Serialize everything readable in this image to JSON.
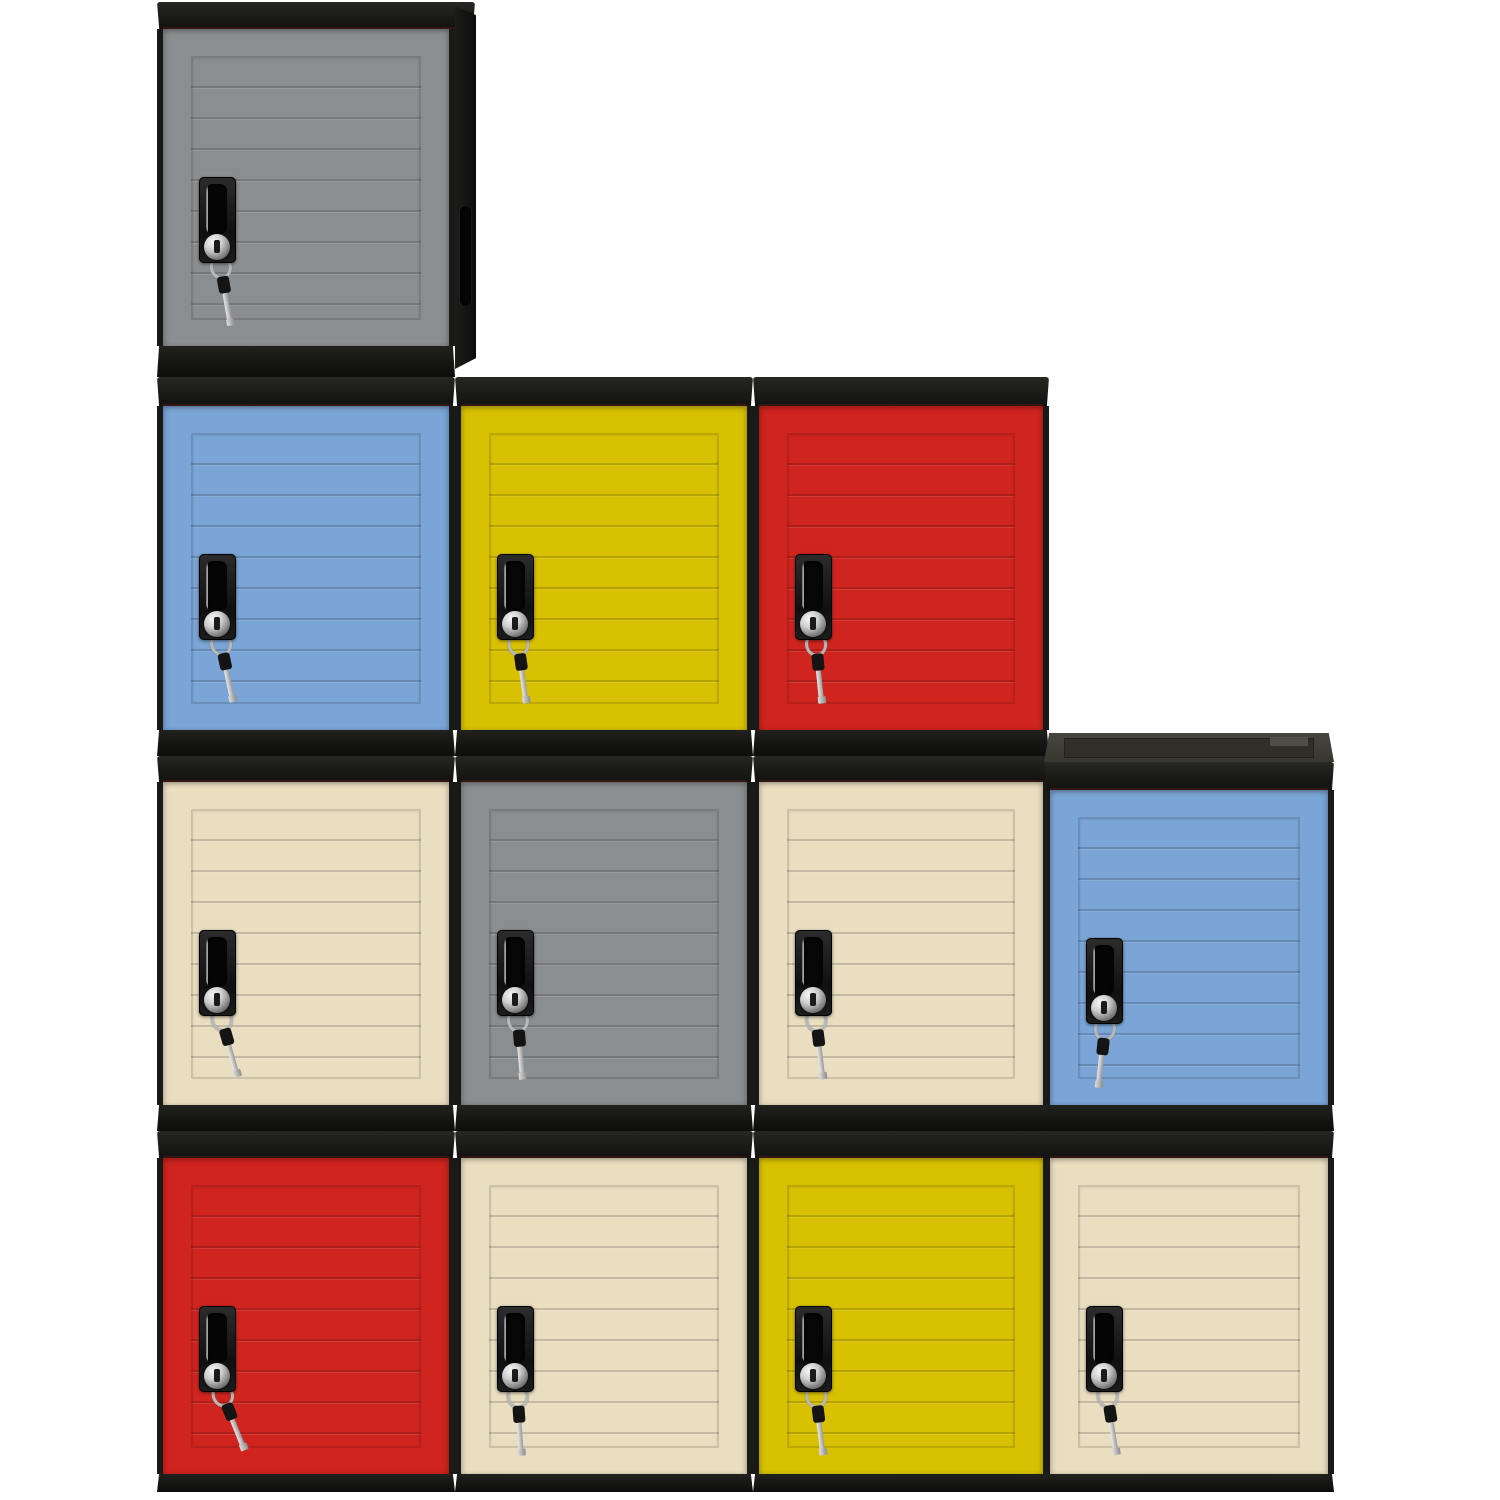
{
  "scene": {
    "background": "#ffffff",
    "image_width": 1500,
    "image_height": 1500
  },
  "palette": {
    "frame_black": "#191917",
    "cap_black": "#1a1a17",
    "base_black": "#141412",
    "side_black": "#0d0d0b",
    "top_surface_gray": "#37362f",
    "cap_accent_maroon": "#601a16",
    "chrome_light": "#f6f6f6",
    "chrome_dark": "#4d4d4d",
    "key_black": "#141414",
    "door_colors": {
      "gray": "#8b8e90",
      "blue": "#7aa5d6",
      "yellow": "#d8c103",
      "red": "#d0251f",
      "cream": "#e9dec0"
    }
  },
  "grid_rows": [
    [
      "gray"
    ],
    [
      "blue",
      "yellow",
      "red"
    ],
    [
      "cream",
      "gray",
      "cream",
      "blue"
    ],
    [
      "red",
      "cream",
      "yellow",
      "cream"
    ]
  ],
  "lockers": [
    {
      "id": "locker-gray-r1c1",
      "row": 1,
      "col": 1,
      "color": "gray",
      "x": 157,
      "y": 2,
      "w": 298,
      "top_h": 0,
      "cap_h": 27,
      "door_h": 317,
      "base_h": 31,
      "side_panel": true,
      "top_surface": false,
      "key_rot": -10
    },
    {
      "id": "locker-blue-r2c1",
      "row": 2,
      "col": 1,
      "color": "blue",
      "x": 157,
      "y": 377,
      "w": 298,
      "top_h": 0,
      "cap_h": 29,
      "door_h": 324,
      "base_h": 26,
      "side_panel": false,
      "top_surface": false,
      "key_rot": -12
    },
    {
      "id": "locker-yellow-r2c2",
      "row": 2,
      "col": 2,
      "color": "yellow",
      "x": 455,
      "y": 377,
      "w": 298,
      "top_h": 0,
      "cap_h": 29,
      "door_h": 324,
      "base_h": 26,
      "side_panel": false,
      "top_surface": false,
      "key_rot": -8
    },
    {
      "id": "locker-red-r2c3",
      "row": 2,
      "col": 3,
      "color": "red",
      "x": 753,
      "y": 377,
      "w": 296,
      "top_h": 0,
      "cap_h": 29,
      "door_h": 324,
      "base_h": 26,
      "side_panel": false,
      "top_surface": false,
      "key_rot": -6
    },
    {
      "id": "locker-cream-r3c1",
      "row": 3,
      "col": 1,
      "color": "cream",
      "x": 157,
      "y": 756,
      "w": 298,
      "top_h": 0,
      "cap_h": 26,
      "door_h": 323,
      "base_h": 26,
      "side_panel": false,
      "top_surface": false,
      "key_rot": -16
    },
    {
      "id": "locker-gray-r3c2",
      "row": 3,
      "col": 2,
      "color": "gray",
      "x": 455,
      "y": 756,
      "w": 298,
      "top_h": 0,
      "cap_h": 26,
      "door_h": 323,
      "base_h": 26,
      "side_panel": false,
      "top_surface": false,
      "key_rot": -5
    },
    {
      "id": "locker-cream-r3c3",
      "row": 3,
      "col": 3,
      "color": "cream",
      "x": 753,
      "y": 756,
      "w": 296,
      "top_h": 0,
      "cap_h": 26,
      "door_h": 323,
      "base_h": 26,
      "side_panel": false,
      "top_surface": false,
      "key_rot": -7
    },
    {
      "id": "locker-blue-r3c4",
      "row": 3,
      "col": 4,
      "color": "blue",
      "x": 1044,
      "y": 733,
      "w": 290,
      "top_h": 29,
      "cap_h": 28,
      "door_h": 315,
      "base_h": 26,
      "side_panel": false,
      "top_surface": true,
      "key_rot": 6
    },
    {
      "id": "locker-red-r4c1",
      "row": 4,
      "col": 1,
      "color": "red",
      "x": 157,
      "y": 1131,
      "w": 298,
      "top_h": 0,
      "cap_h": 27,
      "door_h": 316,
      "base_h": 18,
      "side_panel": false,
      "top_surface": false,
      "key_rot": -22
    },
    {
      "id": "locker-cream-r4c2",
      "row": 4,
      "col": 2,
      "color": "cream",
      "x": 455,
      "y": 1131,
      "w": 298,
      "top_h": 0,
      "cap_h": 27,
      "door_h": 316,
      "base_h": 18,
      "side_panel": false,
      "top_surface": false,
      "key_rot": -4
    },
    {
      "id": "locker-yellow-r4c3",
      "row": 4,
      "col": 3,
      "color": "yellow",
      "x": 753,
      "y": 1131,
      "w": 296,
      "top_h": 0,
      "cap_h": 27,
      "door_h": 316,
      "base_h": 18,
      "side_panel": false,
      "top_surface": false,
      "key_rot": -7
    },
    {
      "id": "locker-cream-r4c4",
      "row": 4,
      "col": 4,
      "color": "cream",
      "x": 1044,
      "y": 1131,
      "w": 290,
      "top_h": 0,
      "cap_h": 27,
      "door_h": 316,
      "base_h": 18,
      "side_panel": false,
      "top_surface": false,
      "key_rot": -9
    }
  ]
}
